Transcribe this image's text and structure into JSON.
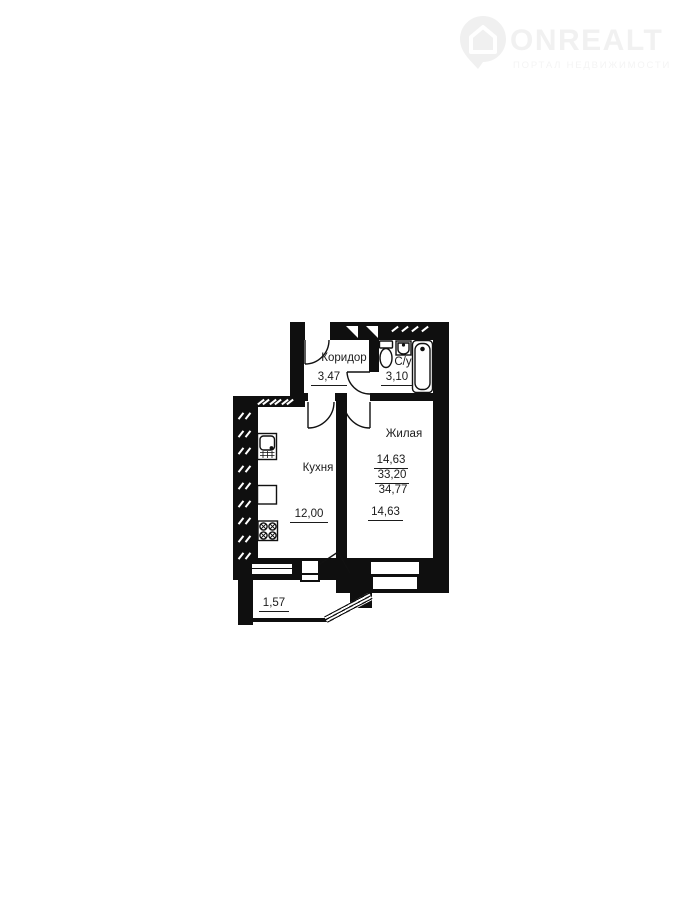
{
  "logo": {
    "brand": "ONREALT",
    "tagline": "ПОРТАЛ НЕДВИЖИМОСТИ",
    "icon": "house-pin-icon",
    "color": "#f1f1f1"
  },
  "floorplan": {
    "wall_color": "#0f0f0f",
    "text_color": "#1b1b1b",
    "rooms": {
      "corridor": {
        "label": "Коридор",
        "area": "3,47"
      },
      "bathroom": {
        "label": "С/у",
        "area": "3,10"
      },
      "kitchen": {
        "label": "Кухня",
        "area": "12,00"
      },
      "living": {
        "label": "Жилая",
        "area": "14,63"
      },
      "balcony": {
        "area": "1,57"
      }
    },
    "area_summary": {
      "living_area": "14,63",
      "apartment_area": "33,20",
      "total_area": "34,77"
    }
  }
}
